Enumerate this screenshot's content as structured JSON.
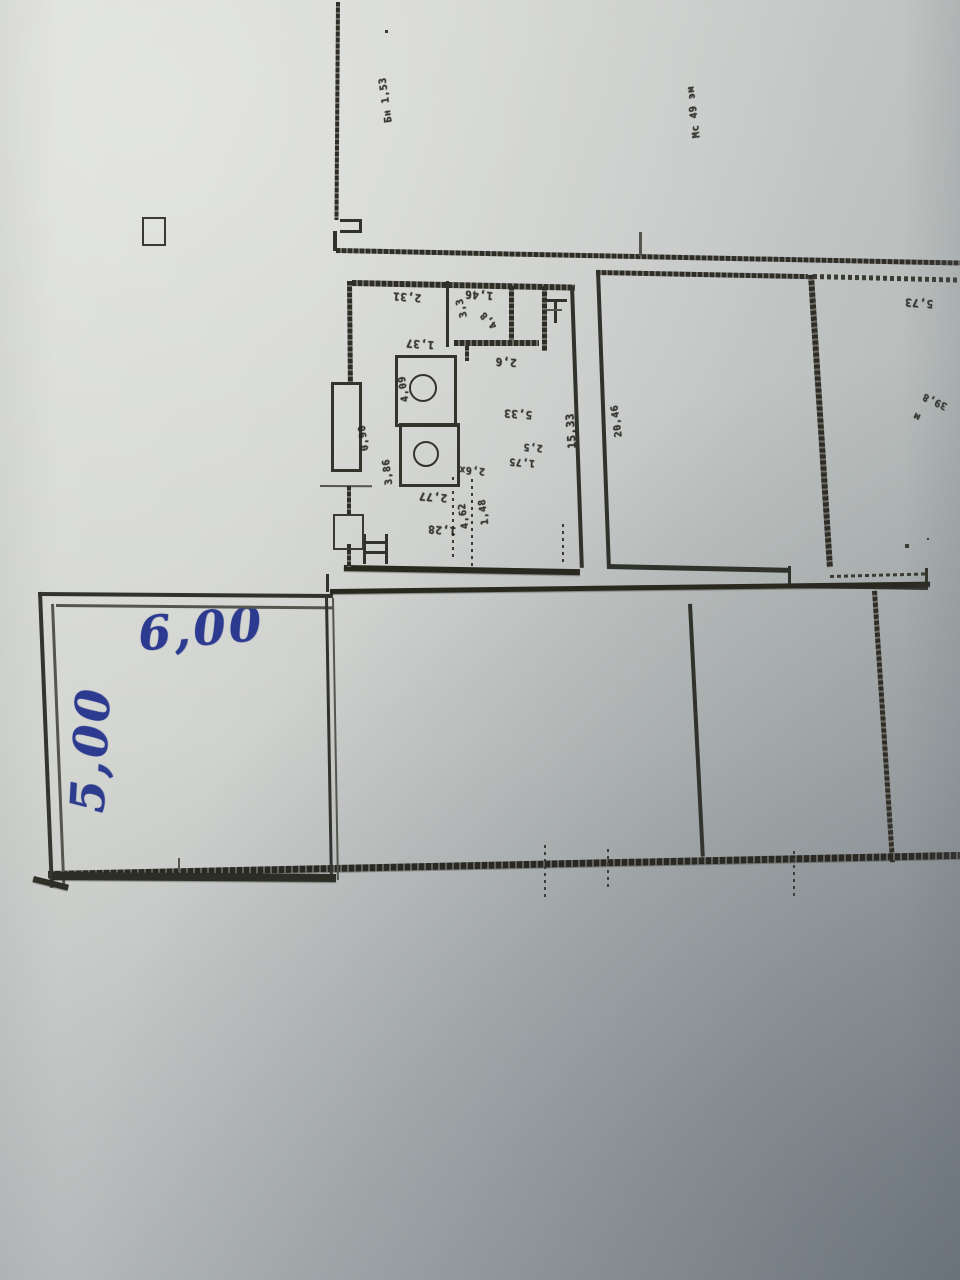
{
  "meta": {
    "kind": "photo-of-printed-floor-plan",
    "orientation_note": "printed plan is rotated 180deg; small dimension numbers appear upside down"
  },
  "colors": {
    "ink_blue": "#2c3b8f",
    "print_line": "#32322c",
    "paper_light": "#dadcd6",
    "paper_shadow": "#a2a8aa"
  },
  "handwritten": {
    "width_label": "6,00",
    "height_label": "5,00"
  },
  "plan": {
    "walls": [
      {
        "name": "exterior-wall-top-left-vertical",
        "x": 336,
        "y": 2,
        "w": 4,
        "h": 218,
        "rot": 0.4,
        "style": "hatch-v"
      },
      {
        "name": "wall-notch-top",
        "x": 340,
        "y": 219,
        "w": 22,
        "h": 3,
        "rot": 0,
        "style": "solid"
      },
      {
        "name": "wall-notch-right",
        "x": 359,
        "y": 219,
        "w": 3,
        "h": 14,
        "rot": 0,
        "style": "solid"
      },
      {
        "name": "wall-notch-bottom",
        "x": 340,
        "y": 230,
        "w": 22,
        "h": 3,
        "rot": 0,
        "style": "solid"
      },
      {
        "name": "wall-notch-stub",
        "x": 333,
        "y": 231,
        "w": 4,
        "h": 20,
        "rot": 0,
        "style": "solid"
      },
      {
        "name": "long-upper-wall",
        "x": 336,
        "y": 248,
        "w": 626,
        "h": 5,
        "rot": 1.15,
        "style": "hatch-h"
      },
      {
        "name": "tick-above-middle-room",
        "x": 639,
        "y": 232,
        "w": 2.5,
        "h": 24,
        "rot": 0,
        "style": "solid-light"
      },
      {
        "name": "middle-room-top-wall",
        "x": 596,
        "y": 270,
        "w": 212,
        "h": 5,
        "rot": 1.1,
        "style": "hatch-h"
      },
      {
        "name": "right-room-top-wall",
        "x": 813,
        "y": 274,
        "w": 148,
        "h": 5,
        "rot": 1.4,
        "style": "dash-h"
      },
      {
        "name": "middle-room-left-wall",
        "x": 596,
        "y": 270,
        "w": 3.5,
        "h": 297,
        "rot": -2.1,
        "style": "solid"
      },
      {
        "name": "middle-room-right-wall",
        "x": 808,
        "y": 275,
        "w": 6,
        "h": 293,
        "rot": -3.7,
        "style": "hatch-v"
      },
      {
        "name": "middle-room-bottom-wall",
        "x": 607,
        "y": 564,
        "w": 184,
        "h": 4.5,
        "rot": 1.2,
        "style": "solid"
      },
      {
        "name": "step-wall-jog",
        "x": 788,
        "y": 566,
        "w": 3,
        "h": 20,
        "rot": 0,
        "style": "solid"
      },
      {
        "name": "step-wall-horizontal",
        "x": 788,
        "y": 584,
        "w": 140,
        "h": 4,
        "rot": 0.8,
        "style": "solid"
      },
      {
        "name": "right-room-bottom-dashed",
        "x": 830,
        "y": 575,
        "w": 98,
        "h": 3,
        "rot": -1.5,
        "style": "dash-h"
      },
      {
        "name": "right-room-bottom-stub",
        "x": 925,
        "y": 568,
        "w": 3,
        "h": 18,
        "rot": 0,
        "style": "solid"
      },
      {
        "name": "hall-top-wall",
        "x": 330,
        "y": 589,
        "w": 600,
        "h": 4.5,
        "rot": -0.7,
        "style": "solid-thick"
      },
      {
        "name": "hall-divider-solid",
        "x": 688,
        "y": 604,
        "w": 3.5,
        "h": 253,
        "rot": -2.9,
        "style": "solid"
      },
      {
        "name": "hall-divider-hatched",
        "x": 872,
        "y": 591,
        "w": 5,
        "h": 272,
        "rot": -3.8,
        "style": "hatch-v"
      },
      {
        "name": "hall-bottom-wall",
        "x": 48,
        "y": 871,
        "w": 912,
        "h": 7,
        "rot": -1.2,
        "style": "hatch-h-thick"
      },
      {
        "name": "bottom-tick-1",
        "x": 178,
        "y": 858,
        "w": 2,
        "h": 14,
        "rot": 0,
        "style": "solid-light"
      },
      {
        "name": "bottom-tick-2",
        "x": 544,
        "y": 845,
        "w": 2,
        "h": 52,
        "rot": 0,
        "style": "dotted-v"
      },
      {
        "name": "bottom-tick-3",
        "x": 607,
        "y": 849,
        "w": 2,
        "h": 40,
        "rot": 0,
        "style": "dotted-v"
      },
      {
        "name": "bottom-tick-4",
        "x": 793,
        "y": 851,
        "w": 2,
        "h": 46,
        "rot": 0,
        "style": "dotted-v"
      },
      {
        "name": "annotated-room-top-outer",
        "x": 38,
        "y": 592,
        "w": 295,
        "h": 3.5,
        "rot": 0.4,
        "style": "solid"
      },
      {
        "name": "annotated-room-top-inner",
        "x": 56,
        "y": 604,
        "w": 277,
        "h": 2.5,
        "rot": 0.5,
        "style": "solid-light"
      },
      {
        "name": "annotated-room-left-outer",
        "x": 38,
        "y": 592,
        "w": 3.5,
        "h": 296,
        "rot": -2.3,
        "style": "solid"
      },
      {
        "name": "annotated-room-left-inner",
        "x": 51,
        "y": 604,
        "w": 2.5,
        "h": 283,
        "rot": -2.3,
        "style": "solid-light"
      },
      {
        "name": "annotated-room-right-outer",
        "x": 325,
        "y": 598,
        "w": 3,
        "h": 282,
        "rot": -1.0,
        "style": "solid"
      },
      {
        "name": "annotated-room-right-inner",
        "x": 332,
        "y": 598,
        "w": 2,
        "h": 282,
        "rot": -1.0,
        "style": "solid-light"
      },
      {
        "name": "annotated-room-right-stub",
        "x": 326,
        "y": 574,
        "w": 3,
        "h": 18,
        "rot": 0,
        "style": "solid"
      },
      {
        "name": "annotated-room-bottom",
        "x": 52,
        "y": 872,
        "w": 284,
        "h": 8,
        "rot": 0.4,
        "style": "solid-thick"
      },
      {
        "name": "annotated-room-corner-stroke",
        "x": 34,
        "y": 876,
        "w": 36,
        "h": 6,
        "rot": 14,
        "style": "solid-thick"
      },
      {
        "name": "central-block-top-wall",
        "x": 352,
        "y": 280,
        "w": 223,
        "h": 5.5,
        "rot": 1.2,
        "style": "hatch-h"
      },
      {
        "name": "central-block-right-wall",
        "x": 570,
        "y": 286,
        "w": 3.5,
        "h": 282,
        "rot": -2.0,
        "style": "solid"
      },
      {
        "name": "central-block-bottom-wall",
        "x": 344,
        "y": 565,
        "w": 236,
        "h": 6,
        "rot": 1.0,
        "style": "solid-thick"
      },
      {
        "name": "central-block-left-wall-1",
        "x": 347,
        "y": 281,
        "w": 4.5,
        "h": 102,
        "rot": -0.5,
        "style": "hatch-v"
      },
      {
        "name": "door-threshold-line",
        "x": 320,
        "y": 485,
        "w": 52,
        "h": 2,
        "rot": 0.3,
        "style": "solid-light"
      },
      {
        "name": "central-block-left-wall-2",
        "x": 347,
        "y": 486,
        "w": 4,
        "h": 30,
        "rot": 0,
        "style": "hatch-v"
      },
      {
        "name": "central-block-left-wall-3",
        "x": 347,
        "y": 544,
        "w": 4,
        "h": 23,
        "rot": 0,
        "style": "hatch-v"
      },
      {
        "name": "partition-1",
        "x": 446,
        "y": 281,
        "w": 2.5,
        "h": 66,
        "rot": 0,
        "style": "solid"
      },
      {
        "name": "partition-2-hatched",
        "x": 509,
        "y": 286,
        "w": 5,
        "h": 57,
        "rot": 0,
        "style": "hatch-v"
      },
      {
        "name": "partition-3-hatched",
        "x": 542,
        "y": 286,
        "w": 5,
        "h": 65,
        "rot": 0,
        "style": "hatch-v"
      },
      {
        "name": "partition-horizontal-hatched",
        "x": 454,
        "y": 340,
        "w": 85,
        "h": 6,
        "rot": 0,
        "style": "hatch-h"
      },
      {
        "name": "partition-stub",
        "x": 465,
        "y": 346,
        "w": 4,
        "h": 15,
        "rot": 0,
        "style": "hatch-v"
      },
      {
        "name": "dotted-partition-1",
        "x": 471,
        "y": 479,
        "w": 2,
        "h": 88,
        "rot": 0,
        "style": "dotted-v"
      },
      {
        "name": "dotted-partition-2",
        "x": 452,
        "y": 477,
        "w": 2,
        "h": 80,
        "rot": 0,
        "style": "dotted-v"
      },
      {
        "name": "dotted-partition-3",
        "x": 562,
        "y": 524,
        "w": 2,
        "h": 42,
        "rot": 0,
        "style": "dotted-v"
      },
      {
        "name": "stair-symbol-left",
        "x": 363,
        "y": 534,
        "w": 3,
        "h": 30,
        "rot": 0,
        "style": "solid"
      },
      {
        "name": "stair-symbol-bar-1",
        "x": 366,
        "y": 541,
        "w": 21,
        "h": 3,
        "rot": 0,
        "style": "solid"
      },
      {
        "name": "stair-symbol-bar-2",
        "x": 366,
        "y": 551,
        "w": 21,
        "h": 3,
        "rot": 0,
        "style": "solid"
      },
      {
        "name": "stair-symbol-right",
        "x": 385,
        "y": 534,
        "w": 3,
        "h": 30,
        "rot": 0,
        "style": "solid"
      },
      {
        "name": "sink-symbol-bar",
        "x": 544,
        "y": 299,
        "w": 23,
        "h": 3,
        "rot": 0,
        "style": "solid"
      },
      {
        "name": "sink-symbol-stem",
        "x": 554,
        "y": 302,
        "w": 3,
        "h": 21,
        "rot": 0,
        "style": "solid"
      },
      {
        "name": "sink-symbol-bar-2",
        "x": 547,
        "y": 309,
        "w": 15,
        "h": 2,
        "rot": 0,
        "style": "solid-light"
      }
    ],
    "pillars": [
      {
        "name": "wall-pillar-1",
        "x": 331,
        "y": 382,
        "w": 25,
        "h": 84,
        "thin": false
      },
      {
        "name": "wall-pillar-2",
        "x": 333,
        "y": 514,
        "w": 27,
        "h": 32,
        "thin": true
      },
      {
        "name": "wc-room-outline",
        "x": 395,
        "y": 355,
        "w": 56,
        "h": 66,
        "thin": false
      },
      {
        "name": "bath-room-outline",
        "x": 399,
        "y": 423,
        "w": 55,
        "h": 58,
        "thin": false
      },
      {
        "name": "column-symbol",
        "x": 142,
        "y": 217,
        "w": 20,
        "h": 25,
        "thin": true
      }
    ],
    "fixtures": [
      {
        "name": "round-fixture-1",
        "cx": 421,
        "cy": 386,
        "r": 12
      },
      {
        "name": "round-fixture-2",
        "cx": 424,
        "cy": 452,
        "r": 11
      }
    ],
    "labels": [
      {
        "name": "dim-vertical-topleft",
        "text": "Бн 1,53",
        "x": 386,
        "y": 100,
        "rot": 262,
        "fs": 10
      },
      {
        "name": "dim-vertical-topright",
        "text": "Мс 49 эм",
        "x": 694,
        "y": 112,
        "rot": 263,
        "fs": 10
      },
      {
        "name": "dim-2-31",
        "text": "2,31",
        "x": 407,
        "y": 297,
        "rot": 184,
        "fs": 11
      },
      {
        "name": "dim-1-46",
        "text": "1,46",
        "x": 479,
        "y": 295,
        "rot": 183,
        "fs": 11
      },
      {
        "name": "dim-3-3",
        "text": "3,3",
        "x": 462,
        "y": 308,
        "rot": 255,
        "fs": 10
      },
      {
        "name": "dim-4-8",
        "text": "4,8",
        "x": 489,
        "y": 320,
        "rot": 225,
        "fs": 10
      },
      {
        "name": "dim-1-37",
        "text": "1,37",
        "x": 420,
        "y": 344,
        "rot": 184,
        "fs": 11
      },
      {
        "name": "dim-2-6",
        "text": "2,6",
        "x": 506,
        "y": 362,
        "rot": 183,
        "fs": 11
      },
      {
        "name": "dim-4-09",
        "text": "4,09",
        "x": 404,
        "y": 389,
        "rot": 262,
        "fs": 10
      },
      {
        "name": "dim-0-90",
        "text": "0,90",
        "x": 364,
        "y": 438,
        "rot": 262,
        "fs": 10
      },
      {
        "name": "dim-5-33",
        "text": "5,33",
        "x": 518,
        "y": 414,
        "rot": 184,
        "fs": 11
      },
      {
        "name": "dim-2-5",
        "text": "2,5",
        "x": 533,
        "y": 447,
        "rot": 184,
        "fs": 10
      },
      {
        "name": "dim-1-75",
        "text": "1,75",
        "x": 522,
        "y": 462,
        "rot": 184,
        "fs": 10
      },
      {
        "name": "dim-3-86",
        "text": "3,86",
        "x": 388,
        "y": 472,
        "rot": 263,
        "fs": 10
      },
      {
        "name": "dim-2-6x",
        "text": "2,6х",
        "x": 472,
        "y": 470,
        "rot": 184,
        "fs": 10
      },
      {
        "name": "dim-2-77",
        "text": "2,77",
        "x": 433,
        "y": 497,
        "rot": 184,
        "fs": 11
      },
      {
        "name": "dim-1-28",
        "text": "1,28",
        "x": 442,
        "y": 530,
        "rot": 184,
        "fs": 11
      },
      {
        "name": "dim-4-62",
        "text": "4,62",
        "x": 464,
        "y": 516,
        "rot": 262,
        "fs": 10
      },
      {
        "name": "dim-1-48",
        "text": "1,48",
        "x": 484,
        "y": 512,
        "rot": 262,
        "fs": 10
      },
      {
        "name": "dim-15-33",
        "text": "15,33",
        "x": 571,
        "y": 431,
        "rot": 266,
        "fs": 11
      },
      {
        "name": "dim-20-46",
        "text": "20,46",
        "x": 617,
        "y": 421,
        "rot": 262,
        "fs": 10
      },
      {
        "name": "dim-5-73",
        "text": "5,73",
        "x": 919,
        "y": 303,
        "rot": 184,
        "fs": 11
      },
      {
        "name": "dim-39-8",
        "text": "39,8",
        "x": 935,
        "y": 401,
        "rot": 205,
        "fs": 10
      },
      {
        "name": "dim-m",
        "text": "м",
        "x": 917,
        "y": 416,
        "rot": 205,
        "fs": 10
      }
    ],
    "specks": [
      {
        "x": 385,
        "y": 30,
        "s": 3
      },
      {
        "x": 905,
        "y": 544,
        "s": 4
      },
      {
        "x": 927,
        "y": 538,
        "s": 2
      }
    ]
  }
}
